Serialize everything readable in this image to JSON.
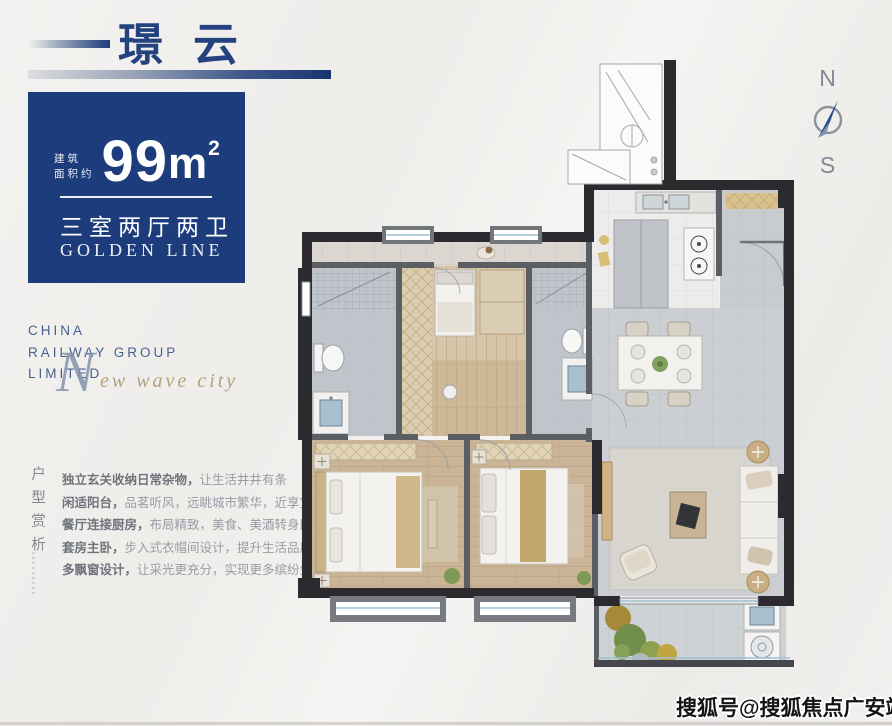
{
  "header": {
    "title": "璟云"
  },
  "area_card": {
    "label_line1": "建筑",
    "label_line2": "面积约",
    "value": "99",
    "unit": "m",
    "sup": "2",
    "layout": "三室两厅两卫",
    "series": "GOLDEN LINE",
    "bg_color": "#1d3c7b"
  },
  "brand": {
    "line1": "CHINA",
    "line2": "RAILWAY GROUP",
    "line3": "LIMITED",
    "script_initial": "N",
    "script_rest": "ew wave city"
  },
  "section": {
    "vertical_title": "户型赏析"
  },
  "features": [
    {
      "lead": "独立玄关收纳日常杂物，",
      "rest": "让生活井井有条"
    },
    {
      "lead": "闲适阳台，",
      "rest": "品茗听风，远眺城市繁华，近享宜境人生"
    },
    {
      "lead": "餐厅连接厨房，",
      "rest": "布局精致，美食、美酒转身即享"
    },
    {
      "lead": "套房主卧，",
      "rest": "步入式衣帽间设计，提升生活品质感"
    },
    {
      "lead": "多飘窗设计，",
      "rest": "让采光更充分，实现更多缤纷生活"
    }
  ],
  "compass": {
    "north": "N",
    "south": "S"
  },
  "watermark": {
    "text": "搜狐号@搜狐焦点广安站"
  },
  "colors": {
    "navy": "#1d3c7b",
    "gold_script": "#b3a17c",
    "brand_blue": "#46618f",
    "wall_dark": "#2b2b2f",
    "wall_mid": "#5b5e63",
    "wood_floor": "#cbb496",
    "tile_gray": "#c9cdd1",
    "accent_tan": "#c3a86b"
  }
}
